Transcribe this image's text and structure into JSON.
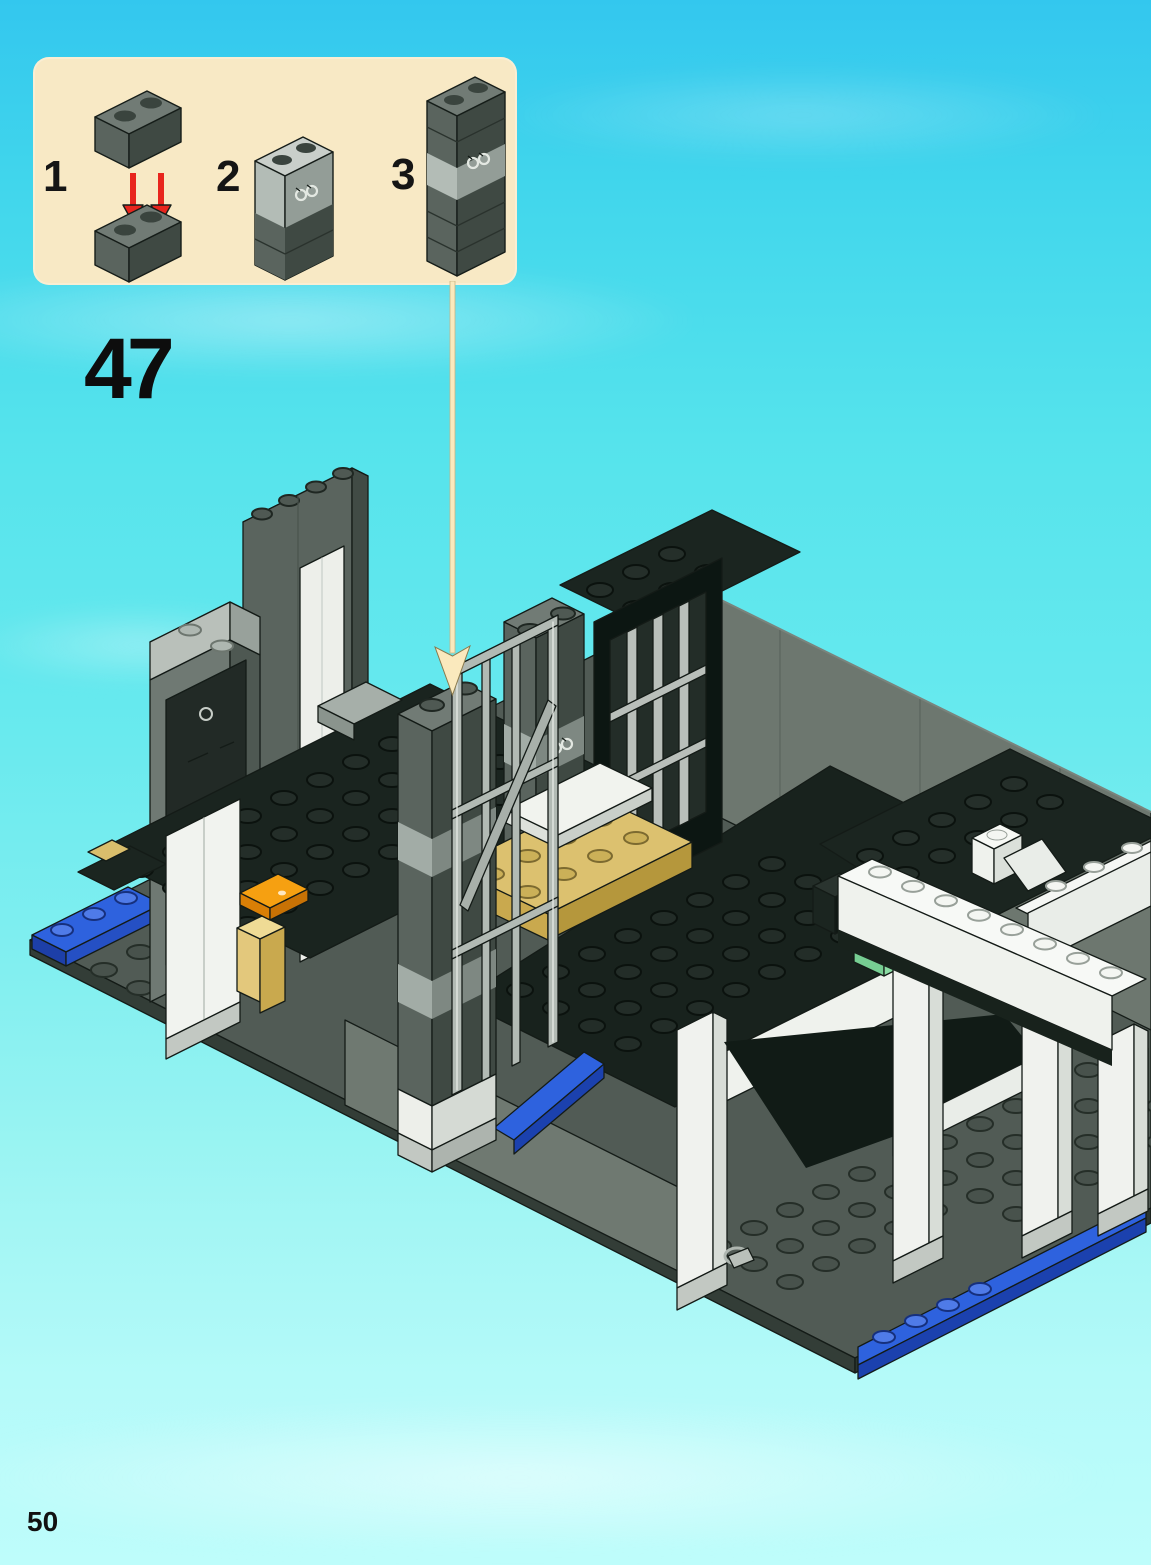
{
  "page": {
    "step_number": "47",
    "page_number": "50"
  },
  "callout": {
    "steps": [
      {
        "label": "1",
        "icon": "dark-brick-pair-insert-icon"
      },
      {
        "label": "2",
        "icon": "handcuff-brick-stack-short-icon"
      },
      {
        "label": "3",
        "icon": "handcuff-brick-stack-tall-icon"
      }
    ]
  },
  "icons": {
    "red_insert_arrow": "red-down-arrow-icon",
    "callout_pointer": "callout-pointer-arrow-icon"
  },
  "illustration": {
    "subject": "lego-police-station-base-model",
    "colors": {
      "background_top": "#33C7EE",
      "background_bottom": "#BEFDFB",
      "callout_bg": "#F8E9C5",
      "pointer_arrow": "#FAE9BD",
      "red_arrow": "#E8251D",
      "brick_dark_gray": "#5A645E",
      "brick_dark_gray_shade": "#3F4943",
      "brick_light_gray": "#B3BCB6",
      "plate_black": "#1B2520",
      "baseplate_gray": "#515B55",
      "wall_gray": "#6D776F",
      "plate_tan": "#DCC16F",
      "plate_blue": "#2E62DE",
      "brick_white": "#F0F2EE",
      "accent_orange": "#F6A011",
      "accent_green": "#A6E9BB",
      "accent_red": "#C0261E"
    }
  }
}
